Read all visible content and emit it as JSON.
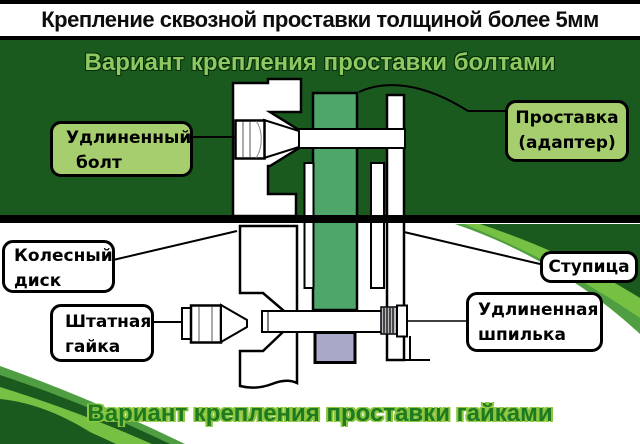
{
  "page": {
    "title": "Крепление сквозной проставки толщиной более 5мм"
  },
  "sections": {
    "bolts_variant": {
      "heading": "Вариант крепления проставки болтами"
    },
    "nuts_variant": {
      "heading": "Вариант крепления проставки гайками"
    }
  },
  "callouts": {
    "extended_bolt": {
      "line1": "Удлиненный",
      "line2": "болт"
    },
    "spacer_adapter": {
      "line1": "Проставка",
      "line2": "(адаптер)"
    },
    "wheel_disk": {
      "line1": "Колесный",
      "line2": "диск"
    },
    "standard_nut": {
      "line1": "Штатная",
      "line2": "гайка"
    },
    "hub": {
      "label": "Ступица"
    },
    "extended_stud": {
      "line1": "Удлиненная",
      "line2": "шпилька"
    }
  },
  "colors": {
    "background_top": "#1b5a1f",
    "spacer_green": "#4fa66b",
    "label_green": "#a6ce6f",
    "heading_green": "#8fc863",
    "footer_green": "#1d7a21",
    "footer_outline": "#8dc63f",
    "swoosh_bright": "#76c143",
    "swoosh_medium": "#4f9e41",
    "center_bore_lavender": "#a8a8c8",
    "thread_gray": "#b9b9c2"
  }
}
